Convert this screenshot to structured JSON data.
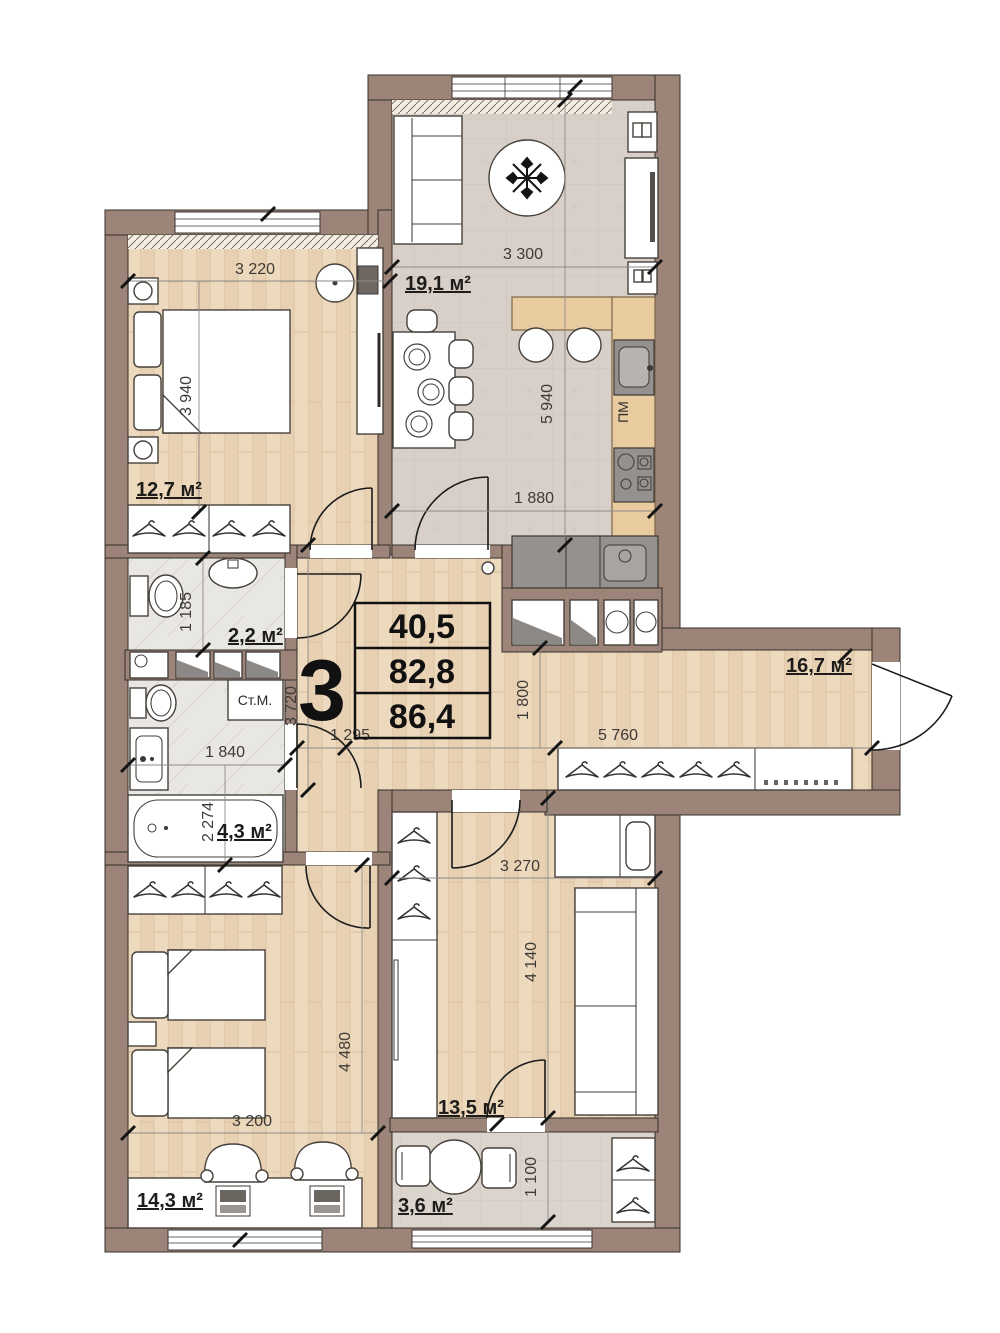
{
  "plan": {
    "apartment_number": "3",
    "summary": {
      "v1": "40,5",
      "v2": "82,8",
      "v3": "86,4"
    },
    "rooms": {
      "kitchen_living": "19,1 м²",
      "bedroom_top": "12,7 м²",
      "wc": "2,2 м²",
      "bathroom": "4,3 м²",
      "hallway": "16,7 м²",
      "bedroom_bottom": "14,3 м²",
      "room_bottom": "13,5 м²",
      "balcony": "3,6 м²"
    },
    "dims": {
      "d3220": "3 220",
      "d3940": "3 940",
      "d3300": "3 300",
      "d5940": "5 940",
      "d1880": "1 880",
      "d1185": "1 185",
      "d3720": "3 720",
      "d1840": "1 840",
      "d2274": "2 274",
      "d1295": "1 295",
      "d1800": "1 800",
      "d5760": "5 760",
      "d3270": "3 270",
      "d4140": "4 140",
      "d3200": "3 200",
      "d4480": "4 480",
      "d1100": "1 100"
    },
    "fixtures": {
      "washing_machine": "Ст.М.",
      "dishwasher": "ПМ"
    }
  }
}
